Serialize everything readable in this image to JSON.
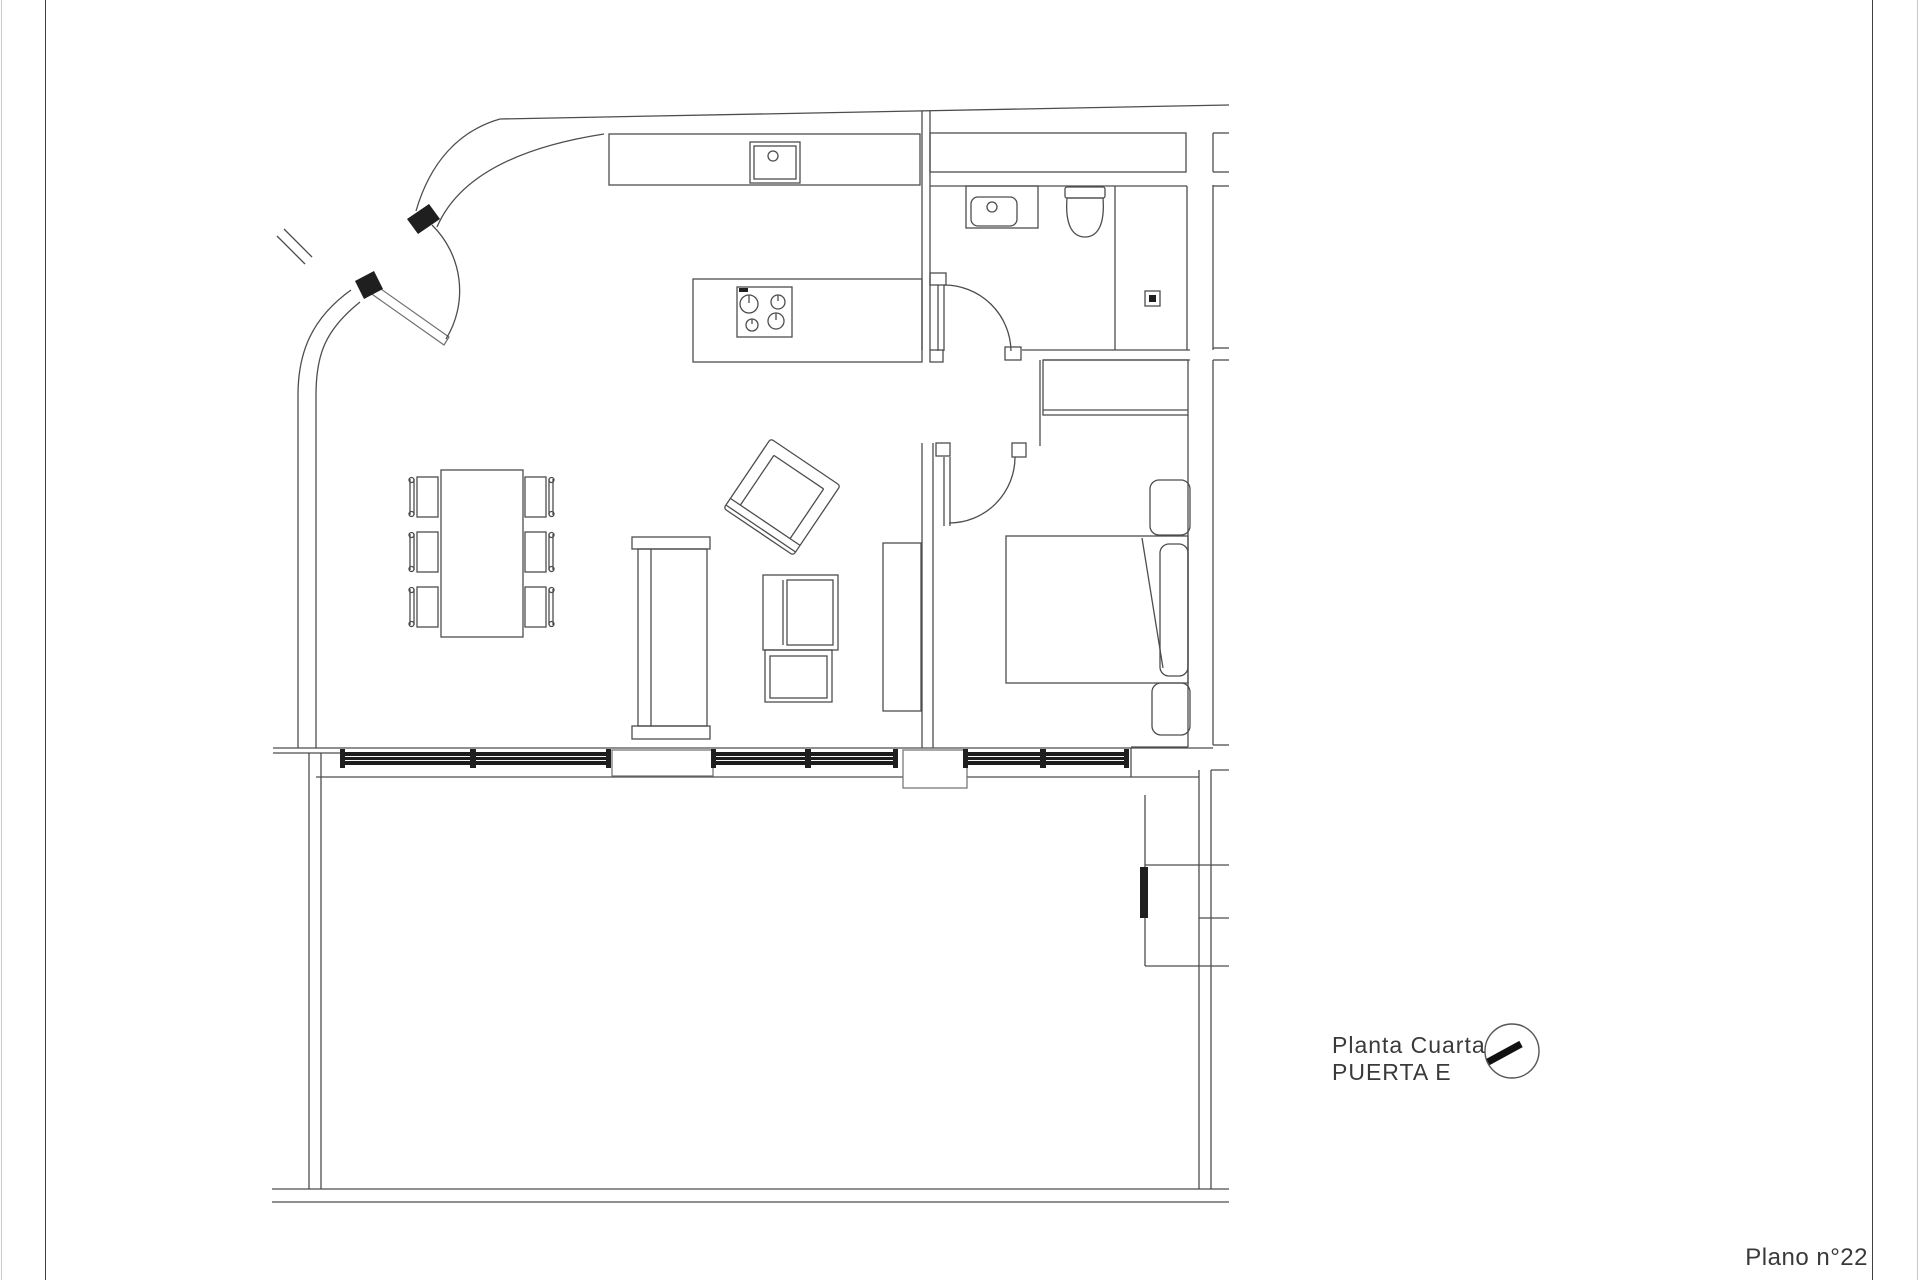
{
  "labels": {
    "floor_title_line1": "Planta Cuarta",
    "floor_title_line2": "PUERTA E",
    "sheet_number": "Plano n°22"
  },
  "symbols": {
    "orientation_icon": "circle-with-thick-hand-pointing-lower-left"
  },
  "colors": {
    "background": "#ffffff",
    "wall_line": "#4d4d4d",
    "dark_fill": "#1f1f1f",
    "window_band": "#1c1c1c",
    "text": "#3a3a3a",
    "sheet_border": "#3f3f3f",
    "faint_edge": "#c9c9c9"
  }
}
